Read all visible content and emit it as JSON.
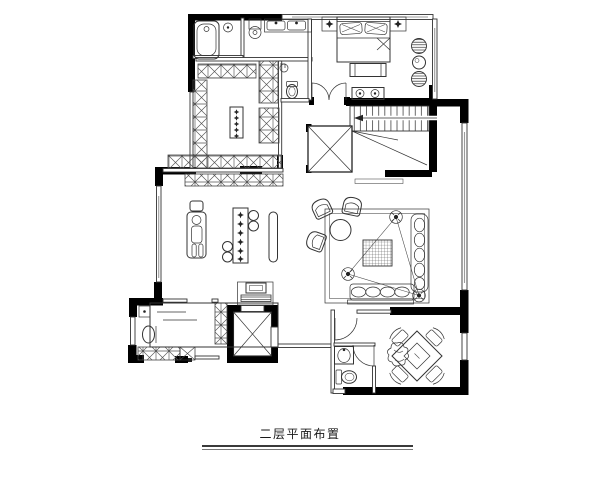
{
  "title": {
    "text": "二层平面布置"
  },
  "drawing": {
    "background": "#ffffff",
    "wall_color": "#000000",
    "line_color": "#333333",
    "glazing_color": "#9b9b9b",
    "stairs_direction_arrow": "left"
  },
  "furniture_icons": {
    "master_bathroom": [
      "bathtub-icon",
      "shower-stool-icon",
      "pedestal-sink-icon",
      "double-basin-vanity-icon"
    ],
    "water_closet": [
      "toilet-icon",
      "corner-basin-icon"
    ],
    "master_bedroom": [
      "double-bed-icon",
      "pillow-icon",
      "nightstand-icon",
      "bed-bench-icon",
      "lounge-chair-icon",
      "round-side-table-icon",
      "media-cabinet-icon",
      "double-swing-door-icon"
    ],
    "walk_in_closet": [
      "wardrobe-cabinet-icon",
      "island-dresser-icon"
    ],
    "stair_hall": [
      "staircase-icon",
      "direction-arrow-icon",
      "void-shaft-icon"
    ],
    "family_lounge": [
      "massage-chair-icon",
      "bar-island-icon",
      "bar-stool-icon",
      "bench-seat-icon",
      "computer-desk-icon",
      "sideboard-icon"
    ],
    "living_area": [
      "armchair-icon",
      "round-tea-table-icon",
      "area-rug-icon",
      "coffee-table-icon",
      "sofa-icon",
      "chaise-icon",
      "speaker-icon"
    ],
    "study": [
      "daybed-icon",
      "reading-chair-icon",
      "side-cabinet-icon",
      "corner-stand-icon"
    ],
    "elevator_lobby": [
      "elevator-shaft-icon",
      "elevator-door-icon"
    ],
    "lower_bathroom": [
      "washbasin-icon",
      "toilet-icon",
      "swing-door-icon"
    ],
    "mahjong_room": [
      "square-game-table-icon",
      "game-chair-icon",
      "plant-icon"
    ]
  }
}
